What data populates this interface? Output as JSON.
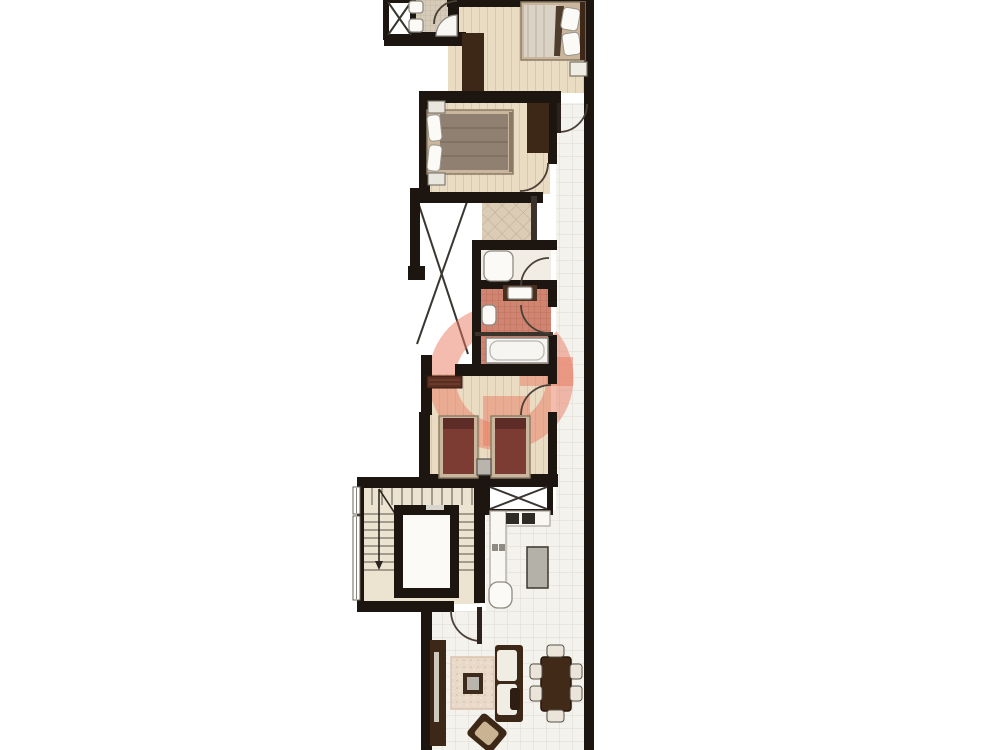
{
  "figure": {
    "type": "architectural-floor-plan",
    "orientation": "vertical-strip-unit",
    "visible_text": [],
    "watermark": {
      "shape": "stylized-letter-G",
      "color": "#e87a5f",
      "opacity": 0.5
    }
  },
  "palette": {
    "wall": "#1d150f",
    "line": "#4a4038",
    "tileFloor": "#f3f2ec",
    "tileLine": "#dedbd2",
    "wood": "#eadcc3",
    "woodLine": "#d9c8aa",
    "bathTile": "#d6cbb8",
    "bathTileLine": "#c2b5a0",
    "pinkTile": "#cf8571",
    "pinkTileLine": "#b96b57",
    "diamondFloor": "#dbccb6",
    "diamondLine": "#bfa98c",
    "stairFloor": "#ece4d1",
    "darkWood": "#3d2817",
    "midWood": "#c9b69d",
    "taupe": "#8f8071",
    "maroon": "#7c3b33",
    "watermark": "#e87a5f",
    "fixture": "#fbfaf6"
  },
  "rooms": [
    {
      "name": "bathroom-top",
      "floor": "beige-tile",
      "fixtures": [
        "toilet",
        "bidet",
        "corner-shower",
        "door"
      ]
    },
    {
      "name": "bedroom-1",
      "floor": "light-wood",
      "furniture": [
        "double-bed",
        "pillows",
        "nightstand",
        "wardrobe"
      ]
    },
    {
      "name": "bedroom-2",
      "floor": "light-wood",
      "furniture": [
        "double-bed",
        "two-nightstands",
        "wardrobe"
      ]
    },
    {
      "name": "dressing-area",
      "floor": "diamond-tile",
      "furniture": []
    },
    {
      "name": "shower-room",
      "floor": "light-tile",
      "fixtures": [
        "shower-tray",
        "door"
      ]
    },
    {
      "name": "bathroom-pink",
      "floor": "pink-tile",
      "fixtures": [
        "wash-basin",
        "toilet",
        "bathtub",
        "door"
      ]
    },
    {
      "name": "hallway",
      "floor": "wood",
      "furniture": [
        "sideboard"
      ]
    },
    {
      "name": "twin-bedroom",
      "floor": "light-wood",
      "furniture": [
        "single-bed",
        "single-bed",
        "nightstand"
      ]
    },
    {
      "name": "stair-core",
      "elements": [
        "u-shaped-staircase",
        "down-arrow",
        "elevator",
        "two-windows"
      ]
    },
    {
      "name": "kitchen",
      "elements": [
        "x-shaft",
        "counter-l-shape",
        "hob-two-burners",
        "sink",
        "island"
      ]
    },
    {
      "name": "corridor",
      "floor": "white-tile",
      "elements": [
        "doors-to-rooms"
      ]
    },
    {
      "name": "living-dining",
      "floor": "white-tile",
      "furniture": [
        "tv-console",
        "rug",
        "coffee-table",
        "sofa",
        "armchair",
        "dining-table",
        "six-chairs",
        "entry-door"
      ]
    },
    {
      "name": "light-well-void",
      "elements": [
        "crossed-x"
      ]
    },
    {
      "name": "shaft-top",
      "elements": [
        "crossed-x"
      ]
    }
  ]
}
